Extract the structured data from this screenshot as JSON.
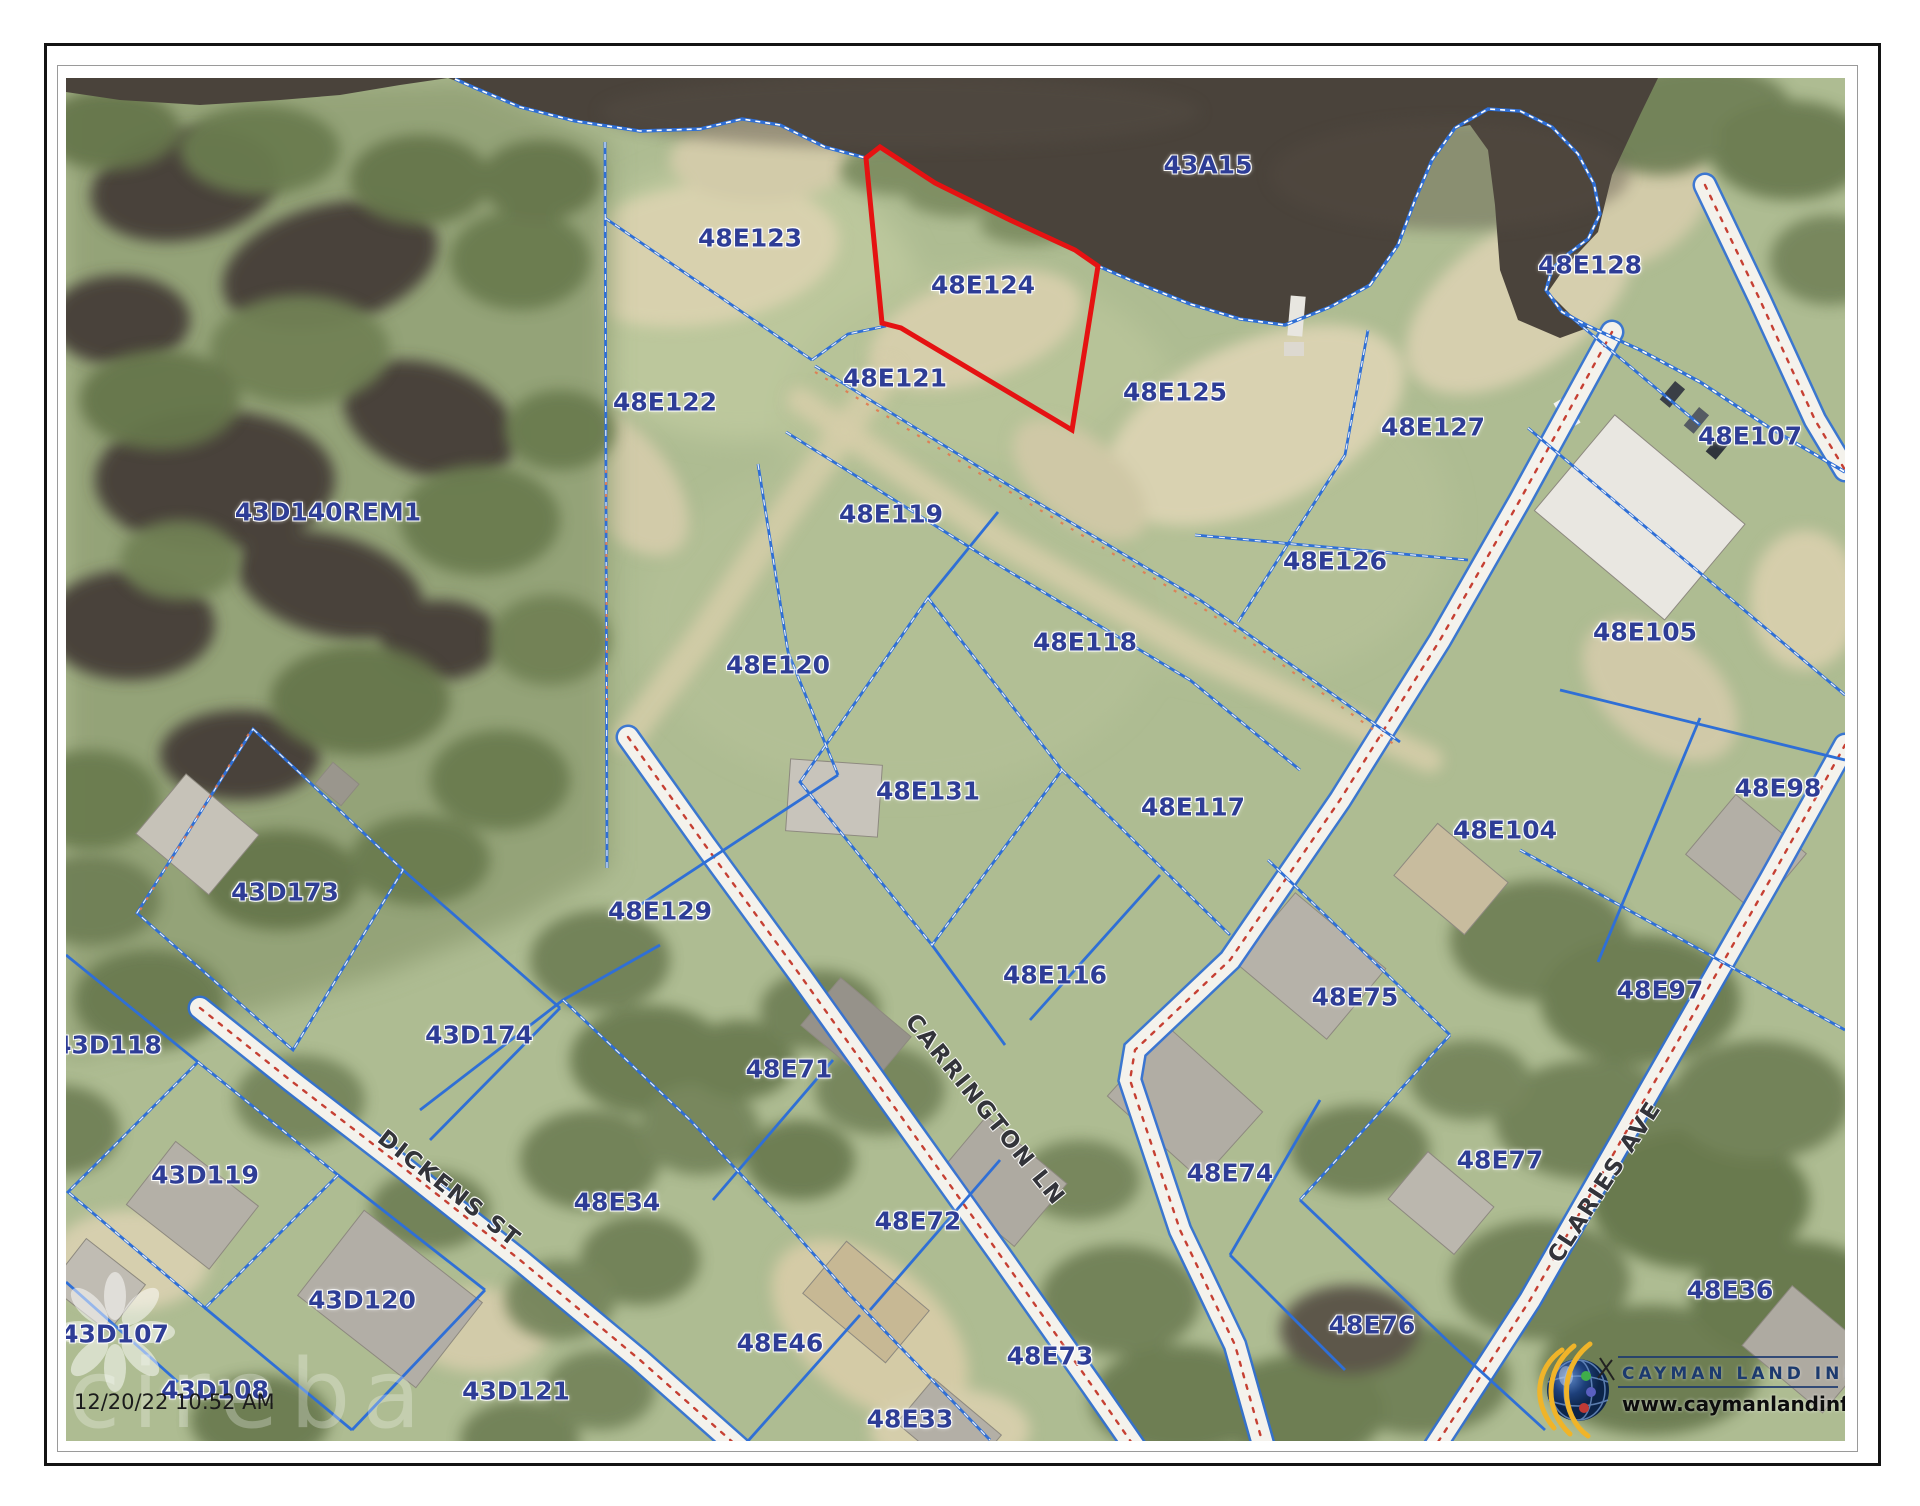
{
  "map": {
    "timestamp": "12/20/22 10:52 AM",
    "watermark_text": "cireba",
    "highlighted_parcel": "48E124",
    "logo": {
      "title": "CAYMAN LAND INFO",
      "website": "www.caymanlandinfo.ky"
    },
    "colors": {
      "water": "#4a433b",
      "land": "#aebc92",
      "forest": "#6e7e54",
      "sand": "#d8d1ae",
      "parcel_line": "#2f6fd6",
      "highlight": "#e51212",
      "label": "#2e3d96",
      "road_label": "#33343a",
      "road_center": "#c64033",
      "logo_navy": "#1c3a6e"
    },
    "parcel_labels": [
      {
        "id": "43A15",
        "x": 1208,
        "y": 165
      },
      {
        "id": "48E123",
        "x": 750,
        "y": 238
      },
      {
        "id": "48E124",
        "x": 983,
        "y": 285
      },
      {
        "id": "48E128",
        "x": 1590,
        "y": 265
      },
      {
        "id": "48E122",
        "x": 665,
        "y": 402
      },
      {
        "id": "48E121",
        "x": 895,
        "y": 378
      },
      {
        "id": "48E125",
        "x": 1175,
        "y": 392
      },
      {
        "id": "48E127",
        "x": 1433,
        "y": 427
      },
      {
        "id": "48E107",
        "x": 1750,
        "y": 436
      },
      {
        "id": "43D140REM1",
        "x": 328,
        "y": 512
      },
      {
        "id": "48E119",
        "x": 891,
        "y": 514
      },
      {
        "id": "48E126",
        "x": 1335,
        "y": 561
      },
      {
        "id": "48E105",
        "x": 1645,
        "y": 632
      },
      {
        "id": "48E120",
        "x": 778,
        "y": 665
      },
      {
        "id": "48E118",
        "x": 1085,
        "y": 642
      },
      {
        "id": "48E98",
        "x": 1778,
        "y": 788
      },
      {
        "id": "48E131",
        "x": 928,
        "y": 791
      },
      {
        "id": "48E117",
        "x": 1193,
        "y": 807
      },
      {
        "id": "48E104",
        "x": 1505,
        "y": 830
      },
      {
        "id": "43D173",
        "x": 285,
        "y": 892
      },
      {
        "id": "48E129",
        "x": 660,
        "y": 911
      },
      {
        "id": "48E116",
        "x": 1055,
        "y": 975
      },
      {
        "id": "48E75",
        "x": 1355,
        "y": 997
      },
      {
        "id": "48E97",
        "x": 1660,
        "y": 990
      },
      {
        "id": "43D174",
        "x": 479,
        "y": 1035
      },
      {
        "id": "43D118",
        "x": 108,
        "y": 1045
      },
      {
        "id": "48E71",
        "x": 789,
        "y": 1069
      },
      {
        "id": "43D119",
        "x": 205,
        "y": 1175
      },
      {
        "id": "48E34",
        "x": 617,
        "y": 1202
      },
      {
        "id": "48E72",
        "x": 918,
        "y": 1221
      },
      {
        "id": "48E74",
        "x": 1230,
        "y": 1173
      },
      {
        "id": "48E77",
        "x": 1500,
        "y": 1160
      },
      {
        "id": "43D120",
        "x": 362,
        "y": 1300
      },
      {
        "id": "48E36",
        "x": 1730,
        "y": 1290
      },
      {
        "id": "43D107",
        "x": 115,
        "y": 1334
      },
      {
        "id": "48E46",
        "x": 780,
        "y": 1343
      },
      {
        "id": "48E76",
        "x": 1372,
        "y": 1325
      },
      {
        "id": "48E73",
        "x": 1050,
        "y": 1356
      },
      {
        "id": "43D108",
        "x": 215,
        "y": 1390
      },
      {
        "id": "43D121",
        "x": 516,
        "y": 1391
      },
      {
        "id": "48E33",
        "x": 910,
        "y": 1419
      }
    ],
    "road_labels": [
      {
        "name": "DICKENS ST",
        "x": 449,
        "y": 1189,
        "rot": 38
      },
      {
        "name": "CARRINGTON LN",
        "x": 985,
        "y": 1110,
        "rot": 51
      },
      {
        "name": "CLARIES AVE",
        "x": 1605,
        "y": 1182,
        "rot": -57
      }
    ]
  }
}
